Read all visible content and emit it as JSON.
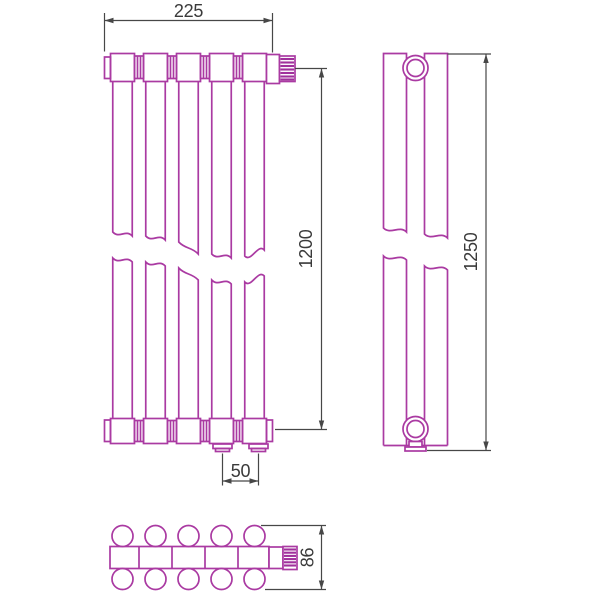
{
  "title": "radiator-technical-drawing",
  "colors": {
    "line": "#aa3aa2",
    "hatch": "#a0309c",
    "dimension_line": "#474747",
    "dimension_text": "#3a3a3a",
    "background": "#ffffff"
  },
  "views": {
    "front": {
      "columns": 5,
      "label_width": "225",
      "label_height": "1200",
      "label_pitch": "50"
    },
    "side": {
      "label_height": "1250"
    },
    "bottom": {
      "tube_rows": 2,
      "tube_columns": 5,
      "label_depth": "86"
    }
  }
}
